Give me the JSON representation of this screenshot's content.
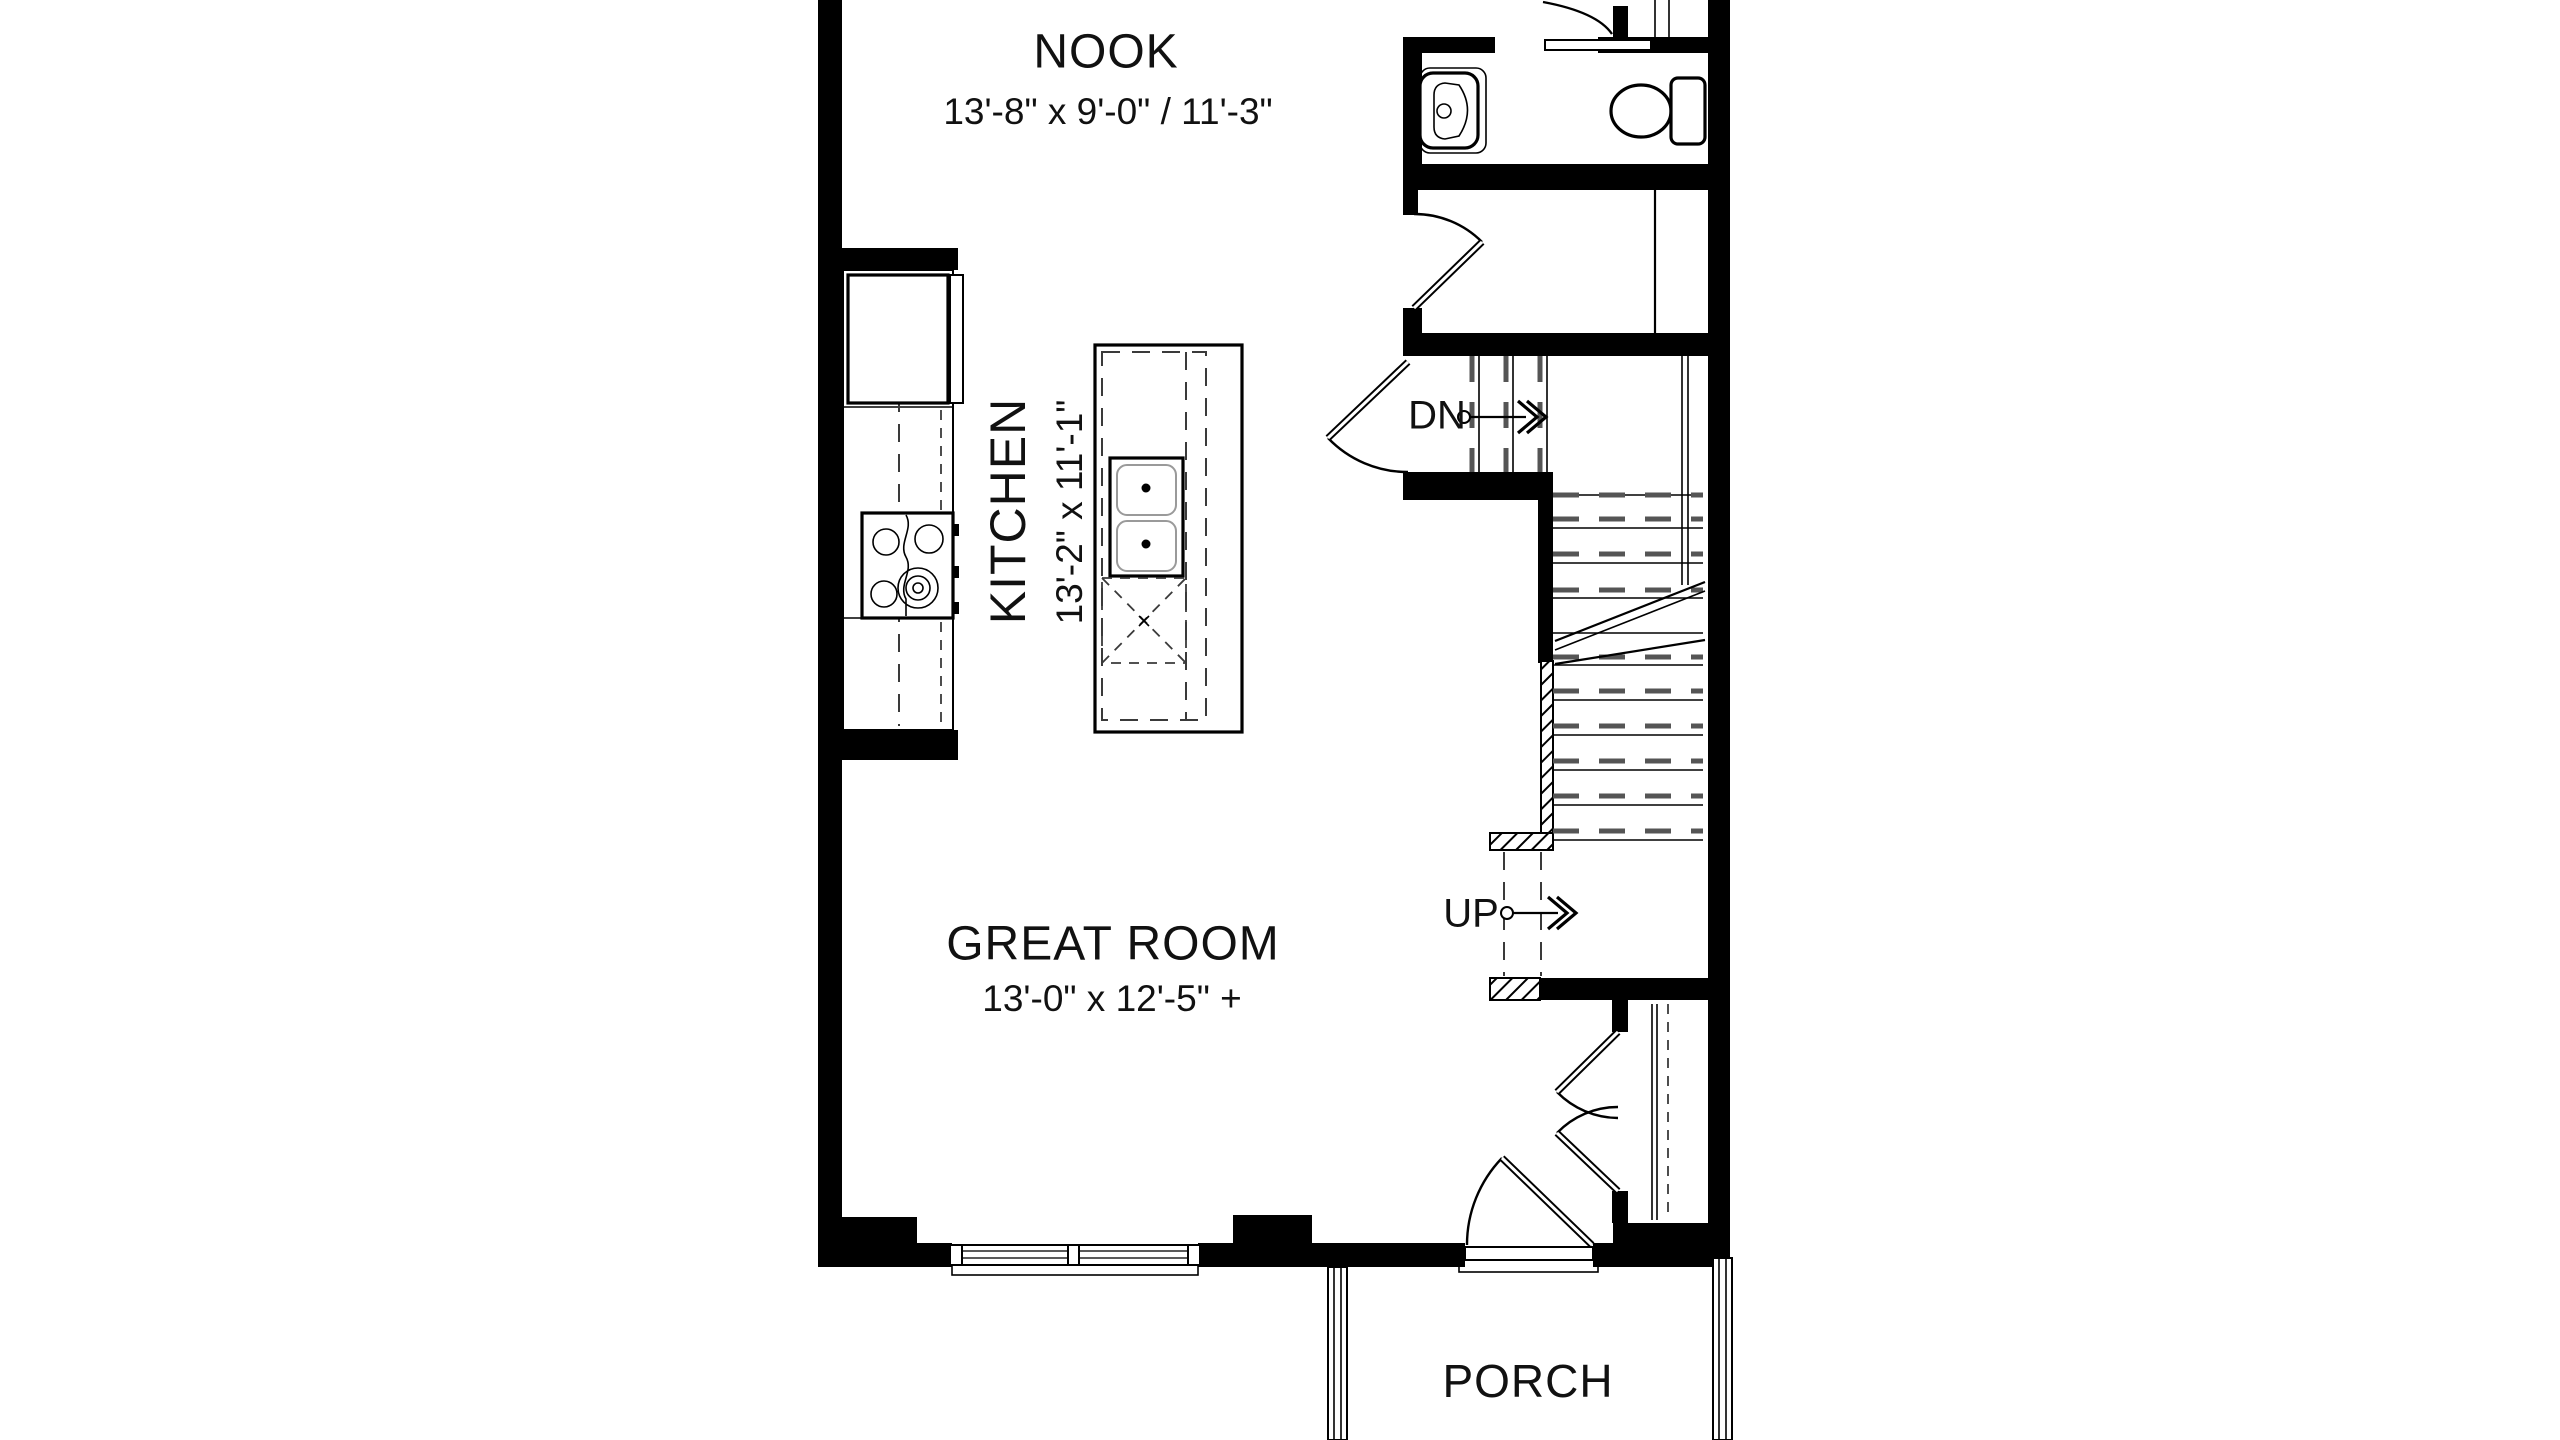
{
  "colors": {
    "background": "#ffffff",
    "wall": "#000000",
    "dash": "#3a3a3a",
    "tread": "#555555",
    "glass": "#5a5a5a",
    "basin": "#9a9a9a"
  },
  "rooms": {
    "nook": {
      "label": "NOOK",
      "dimensions": "13'-8\" x 9'-0\" / 11'-3\""
    },
    "kitchen": {
      "label": "KITCHEN",
      "dimensions": "13'-2\" x 11'-1\""
    },
    "great_room": {
      "label": "GREAT ROOM",
      "dimensions": "13'-0\" x 12'-5\" +"
    },
    "porch": {
      "label": "PORCH"
    }
  },
  "stairs": {
    "down": {
      "label": "DN"
    },
    "up": {
      "label": "UP"
    }
  }
}
